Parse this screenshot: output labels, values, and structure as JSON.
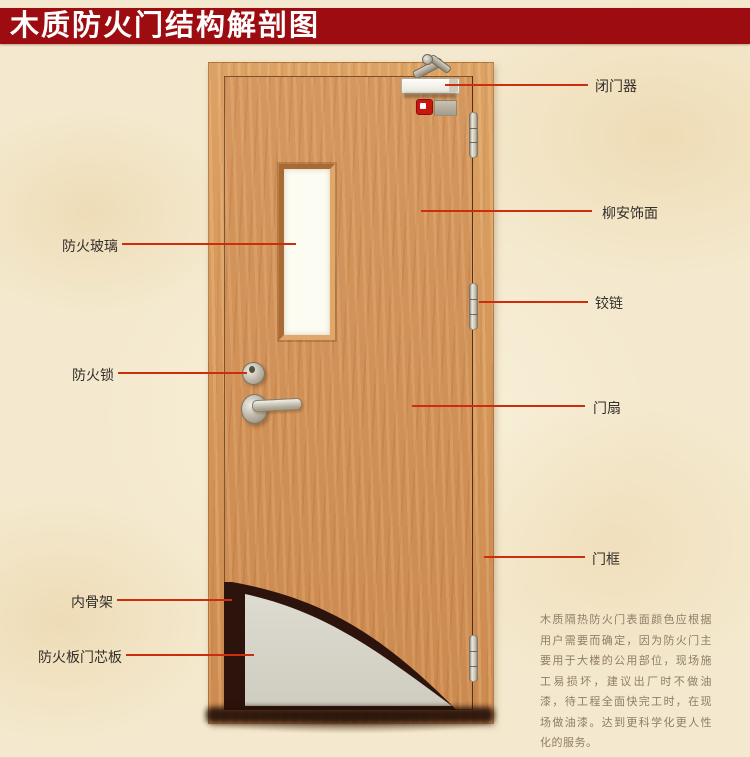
{
  "banner": {
    "title": "木质防火门结构解剖图",
    "bg_color": "#9d0c10",
    "text_color": "#ffffff"
  },
  "callouts": {
    "line_color": "#cb2d0d",
    "right": [
      {
        "id": "door-closer",
        "text": "闭门器"
      },
      {
        "id": "lauan-veneer",
        "text": "柳安饰面"
      },
      {
        "id": "hinge",
        "text": "铰链"
      },
      {
        "id": "door-leaf",
        "text": "门扇"
      },
      {
        "id": "door-frame",
        "text": "门框"
      }
    ],
    "left": [
      {
        "id": "fire-glass",
        "text": "防火玻璃"
      },
      {
        "id": "fire-lock",
        "text": "防火锁"
      },
      {
        "id": "inner-skeleton",
        "text": "内骨架"
      },
      {
        "id": "fire-board-core",
        "text": "防火板门芯板"
      }
    ]
  },
  "description": {
    "text": "木质隔热防火门表面颜色应根据用户需要而确定，因为防火门主要用于大楼的公用部位，现场施工易损坏，建议出厂时不做油漆，待工程全面快完工时，在现场做油漆。达到更科学化更人性化的服务。",
    "text_color": "#8f7d68"
  },
  "colors": {
    "background": "#f4e9ce",
    "wood_frame": "#d9a061",
    "wood_leaf": "#d29055",
    "core_gray": "#d7d4c9",
    "skeleton_dark": "#2c130b"
  }
}
